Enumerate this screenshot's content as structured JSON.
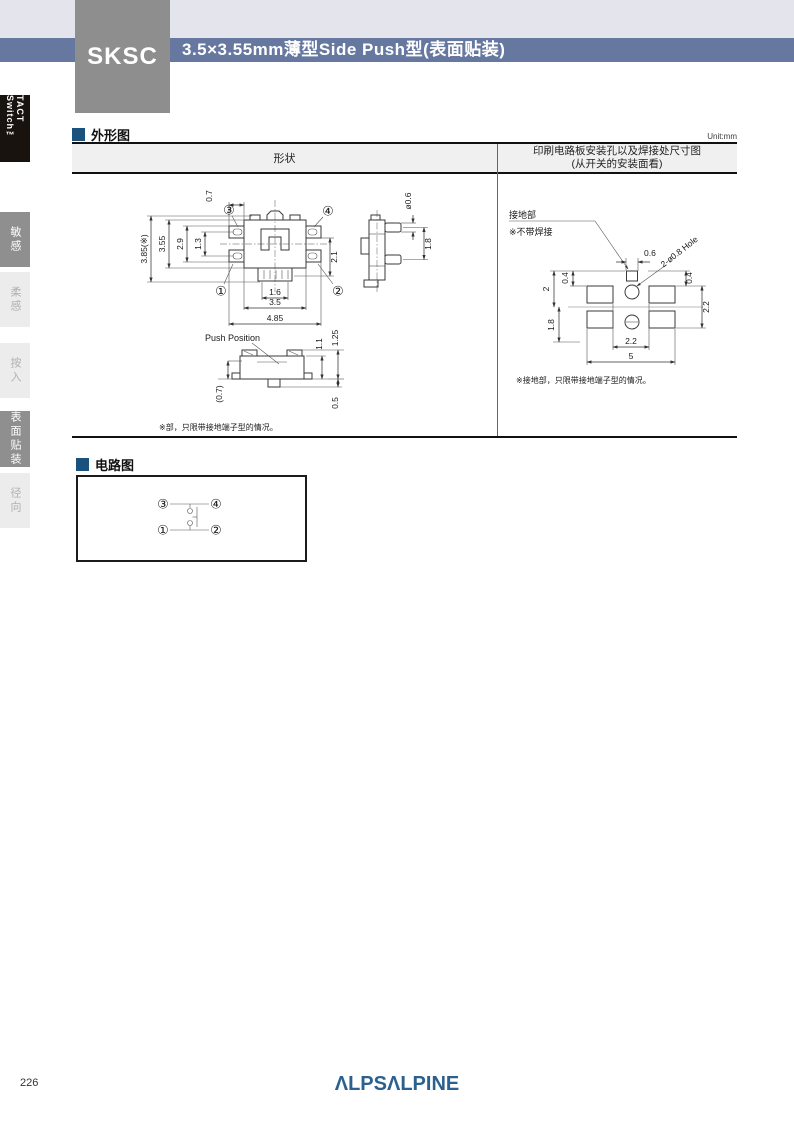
{
  "header": {
    "product_code": "SKSC",
    "title": "3.5×3.55mm薄型Side Push型(表面贴装)"
  },
  "sidebar": {
    "series": "TACT Switch™",
    "tabs": [
      {
        "label": "敏感",
        "active": true
      },
      {
        "label": "柔感",
        "active": false
      },
      {
        "label": "按入",
        "active": false
      },
      {
        "label": "表面贴装",
        "active": true
      },
      {
        "label": "径向",
        "active": false
      }
    ]
  },
  "outline": {
    "section_title": "外形图",
    "unit": "Unit:mm",
    "table": {
      "shape_header": "形状",
      "pcb_header_line1": "印刷电路板安装孔以及焊接处尺寸图",
      "pcb_header_line2": "(从开关的安装面看)"
    },
    "front": {
      "terminals": {
        "t1": "①",
        "t2": "②",
        "t3": "③",
        "t4": "④"
      },
      "dims": {
        "total_height": "3.85(※)",
        "body_height": "3.55",
        "inner_height": "2.9",
        "slot_height": "1.3",
        "tab_width": "0.7",
        "right_height": "2.1",
        "actuator_width": "1.6",
        "body_width": "3.5",
        "total_width": "4.85"
      }
    },
    "side": {
      "dims": {
        "stem_dia": "ø0.6",
        "stem_pitch": "1.8"
      }
    },
    "push": {
      "label": "Push Position",
      "dims": {
        "body_height": "1.1",
        "total_height": "1.25",
        "stem_height": "(0.7)",
        "protrusion": "0.5"
      }
    },
    "shape_note": "※部，只限带接地端子型的情况。",
    "pcb": {
      "ground_label": "接地部",
      "no_solder_label": "※不带焊接",
      "hole_label": "2-ø0.8 Hole",
      "dims": {
        "ground_width": "0.6",
        "ground_gap": "0.4",
        "center_to_ground": "2",
        "center_to_bottom": "1.8",
        "right_gap": "0.4",
        "pad_height": "2.2",
        "pad_gap": "2.2",
        "pad_span": "5"
      },
      "note": "※接地部，只限带接地端子型的情况。"
    }
  },
  "circuit": {
    "section_title": "电路图",
    "terminals": {
      "t1": "①",
      "t2": "②",
      "t3": "③",
      "t4": "④"
    }
  },
  "footer": {
    "page_number": "226",
    "logo_text": "ΛLPSΛLPINE"
  },
  "colors": {
    "band_blue": "#66789f",
    "band_strip": "#e3e4ec",
    "product_box_gray": "#8e8e8e",
    "bullet_navy": "#1a517d",
    "tab_active_gray": "#8f8f8f",
    "logo_blue": "#2b608f"
  }
}
